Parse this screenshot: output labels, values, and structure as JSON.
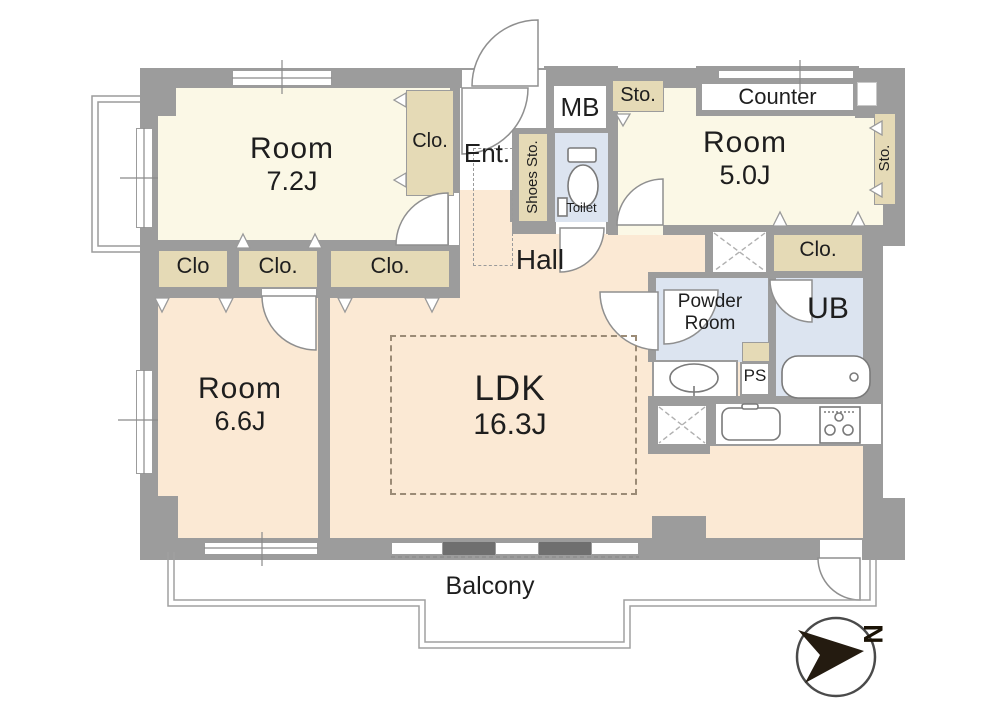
{
  "rooms": {
    "room72": {
      "name": "Room",
      "size": "7.2J"
    },
    "room50": {
      "name": "Room",
      "size": "5.0J"
    },
    "room66": {
      "name": "Room",
      "size": "6.6J"
    },
    "ldk": {
      "name": "LDK",
      "size": "16.3J"
    },
    "hall": "Hall",
    "entrance": "Ent.",
    "toilet": "Toilet",
    "powder_room": "Powder Room",
    "unit_bath": "UB",
    "pipe_space": "PS",
    "meter_box": "MB",
    "balcony": "Balcony",
    "counter": "Counter"
  },
  "storage": {
    "closet_room72": "Clo.",
    "shoes_storage": "Shoes Sto.",
    "storage_top": "Sto.",
    "storage_right": "Sto.",
    "closet_right": "Clo.",
    "closet_1": "Clo",
    "closet_2": "Clo.",
    "closet_3": "Clo."
  },
  "compass": {
    "north": "N"
  },
  "colors": {
    "wall": "#9c9c9c",
    "bedroom_fill": "#fbf8e6",
    "living_fill": "#fbe9d4",
    "storage_fill": "#e5dab6",
    "wet_area_fill": "#dce4f0",
    "dark_panel": "#6f6f6f",
    "compass_arrow": "#241b10"
  }
}
